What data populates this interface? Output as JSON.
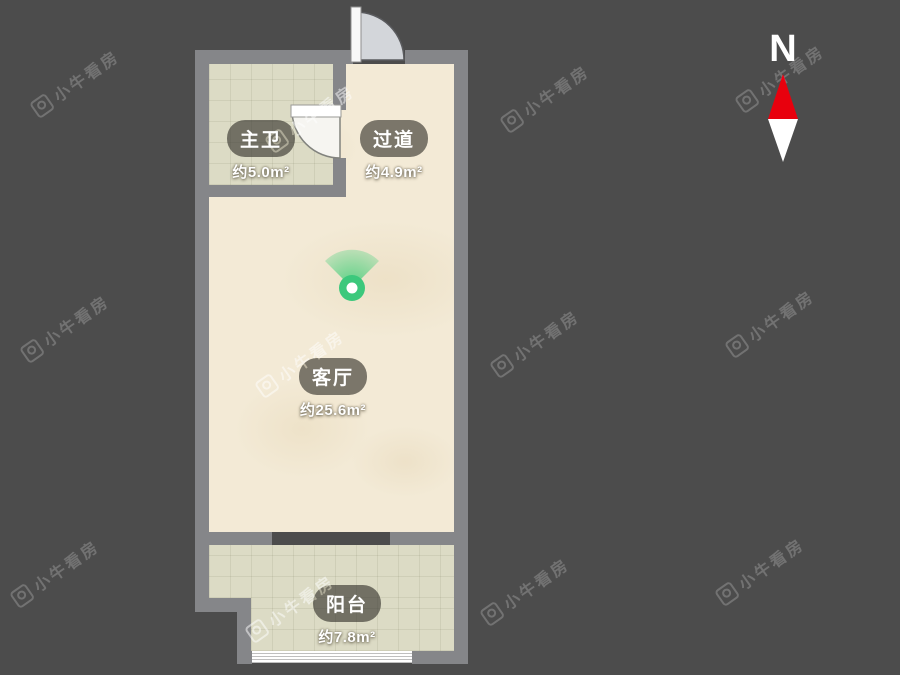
{
  "page": {
    "background_color": "#4c4c4c"
  },
  "watermark": {
    "text": "小牛看房"
  },
  "compass": {
    "north_label": "N",
    "north_color": "#e8000d",
    "south_color": "#ffffff"
  },
  "floorplan": {
    "wall_color": "#858689",
    "colors": {
      "floor": "#f3ead6",
      "tile": "#dcdbc5",
      "viewpoint": "#3cc87c"
    },
    "rooms": [
      {
        "id": "master-bath",
        "name": "主卫",
        "area": "约5.0m²"
      },
      {
        "id": "hallway",
        "name": "过道",
        "area": "约4.9m²"
      },
      {
        "id": "living-room",
        "name": "客厅",
        "area": "约25.6m²"
      },
      {
        "id": "balcony",
        "name": "阳台",
        "area": "约7.8m²"
      }
    ]
  }
}
